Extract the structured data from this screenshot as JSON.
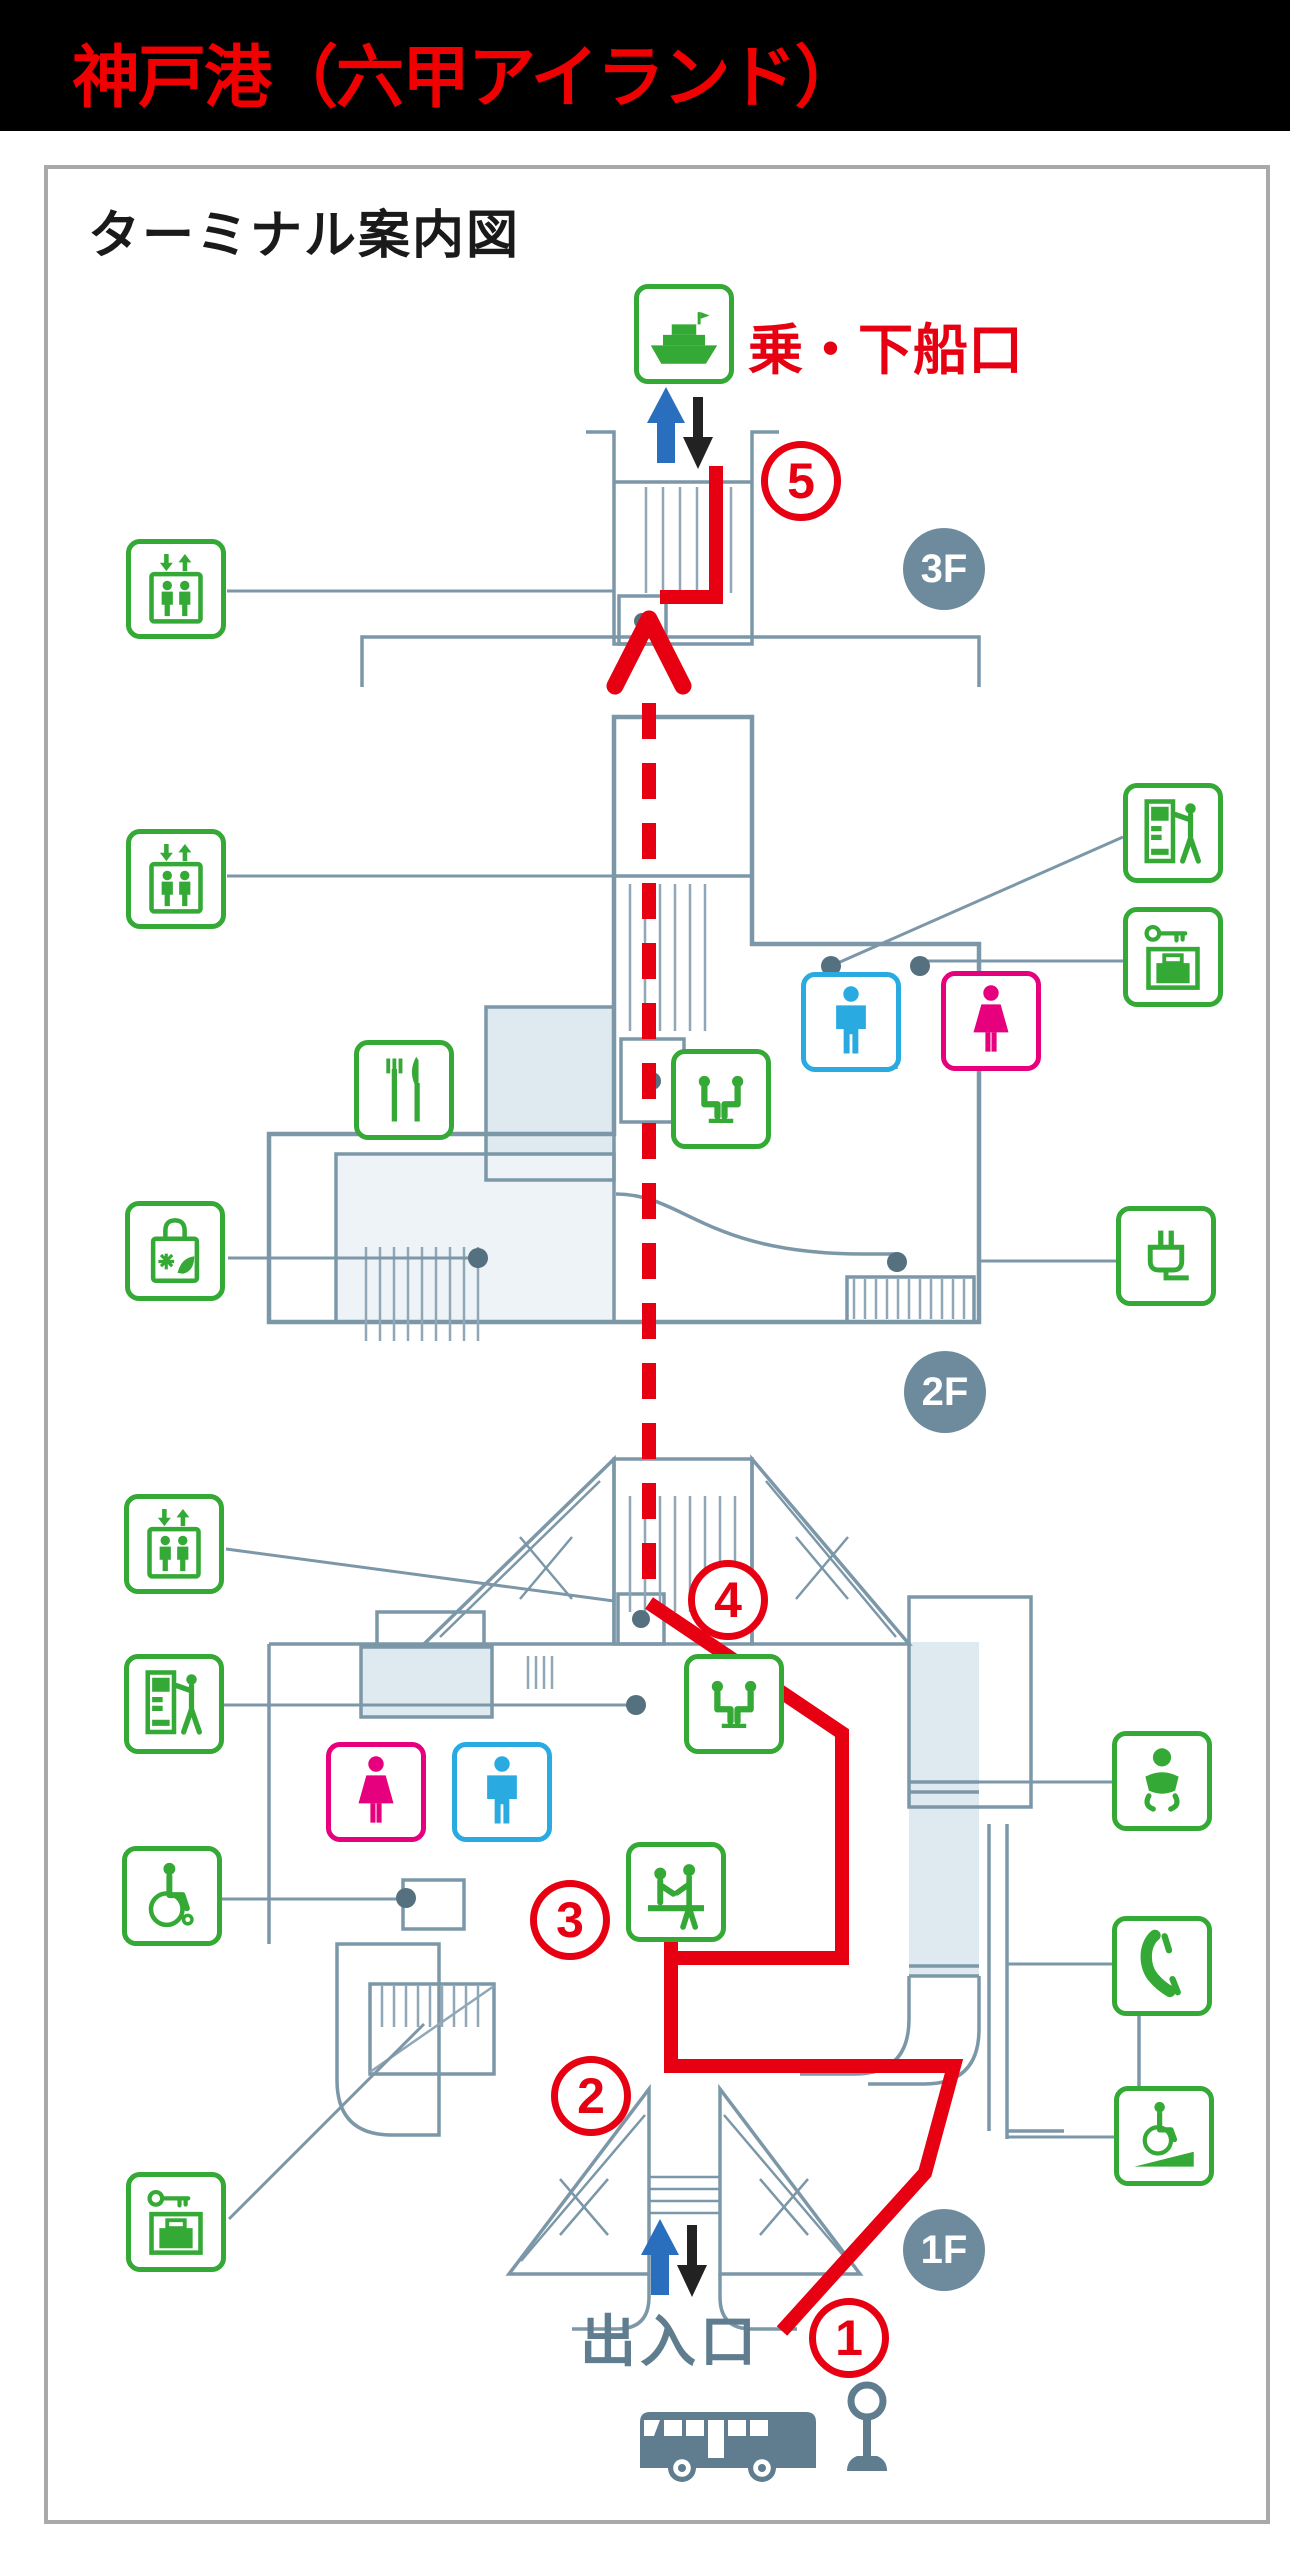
{
  "header": {
    "title": "神戸港（六甲アイランド）"
  },
  "map": {
    "title": "ターミナル案内図",
    "boarding_label": "乗・下船口",
    "entrance_label": "出入口",
    "floor_badges": [
      "3F",
      "2F",
      "1F"
    ],
    "route_steps": [
      "1",
      "2",
      "3",
      "4",
      "5"
    ],
    "icons": [
      "boarding-ship",
      "elevator",
      "vending-machine",
      "coin-locker",
      "mens-toilet",
      "womens-toilet",
      "restaurant",
      "waiting-lounge",
      "shop",
      "power-outlet",
      "wheelchair-access",
      "reception-counter",
      "baby-care",
      "public-phone",
      "wheelchair-slope",
      "bus",
      "bus-stop",
      "up-arrow",
      "down-arrow"
    ],
    "colors": {
      "route_red": "#e60012",
      "icon_green": "#35a936",
      "icon_blue": "#29abe2",
      "icon_pink": "#e6007d",
      "floor_badge": "#6d8b9d",
      "wall": "#7b97a8",
      "entrance_text": "#5f7d8e",
      "header_red": "#f00000"
    }
  }
}
